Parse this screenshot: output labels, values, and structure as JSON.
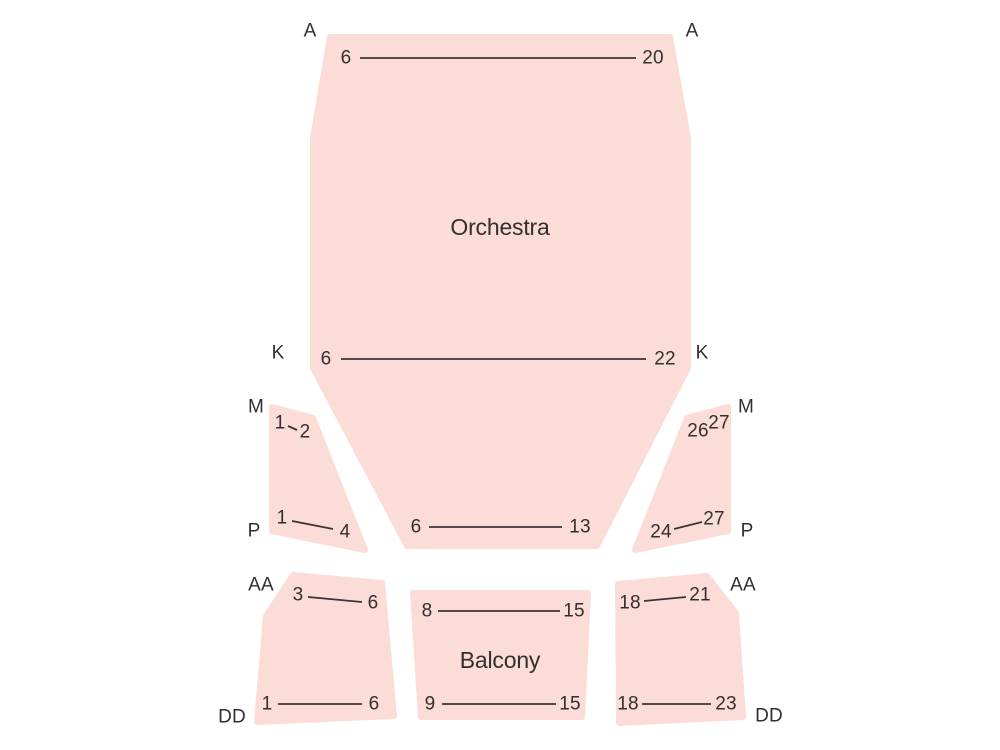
{
  "page": {
    "kind": "theater-seating-chart",
    "background": "#FFFFFF"
  },
  "colors": {
    "section_fill": "#FBDCD7",
    "ink": "#332F2E",
    "row_line": "#3A3534"
  },
  "sections": {
    "orchestra": {
      "name": "Orchestra",
      "row_a": {
        "label_left": "A",
        "label_right": "A",
        "seat_first": "6",
        "seat_last": "20"
      },
      "row_k": {
        "label_left": "K",
        "label_right": "K",
        "seat_first": "6",
        "seat_last": "22"
      },
      "row_front": {
        "seat_first": "6",
        "seat_last": "13"
      }
    },
    "side_left": {
      "row_m": {
        "label": "M",
        "seat_first": "1",
        "seat_last": "2"
      },
      "row_p": {
        "label": "P",
        "seat_first": "1",
        "seat_last": "4"
      }
    },
    "side_right": {
      "row_m": {
        "label": "M",
        "seat_first": "26",
        "seat_last": "27"
      },
      "row_p": {
        "label": "P",
        "seat_first": "24",
        "seat_last": "27"
      }
    },
    "balcony_left": {
      "row_aa": {
        "label": "AA",
        "seat_first": "3",
        "seat_last": "6"
      },
      "row_dd": {
        "label": "DD",
        "seat_first": "1",
        "seat_last": "6"
      }
    },
    "balcony_center": {
      "name": "Balcony",
      "row_top": {
        "seat_first": "8",
        "seat_last": "15"
      },
      "row_bottom": {
        "seat_first": "9",
        "seat_last": "15"
      }
    },
    "balcony_right": {
      "row_aa": {
        "label": "AA",
        "seat_first": "18",
        "seat_last": "21"
      },
      "row_dd": {
        "label": "DD",
        "seat_first": "18",
        "seat_last": "23"
      }
    }
  }
}
